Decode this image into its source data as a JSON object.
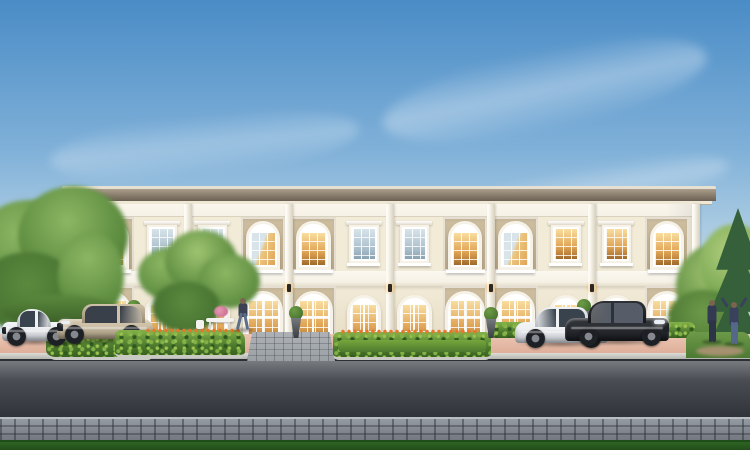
{
  "meta": {
    "description": "Daylight architectural rendering of a symmetric two-storey neoclassical townhome row with arched windows, landscaped front beds, four parked luxury cars, three people and a street with paver sidewalk in the foreground",
    "width_px": 750,
    "height_px": 450
  },
  "palette": {
    "sky_top": "#4a8cc6",
    "sky_mid": "#7fb0d8",
    "sky_low": "#b6d2e5",
    "sky_horizon": "#e9f1f2",
    "roof_edge": "#e6e0d2",
    "roof_fascia_light": "#ab9e8c",
    "roof_fascia_dark": "#6b6052",
    "soffit": "#efe8d7",
    "wall_cream": "#f2ebd8",
    "wall_cream_dark": "#e6dcc3",
    "wall_tan": "#cfbfa1",
    "wall_tan_dark": "#bcab8a",
    "trim": "#f6f2e7",
    "band_shadow": "#d9d2bf",
    "glass_cool_hi": "#d8e4ea",
    "glass_cool_lo": "#a8bdca",
    "glass_warm_hi": "#f9dd9f",
    "glass_warm_lo": "#e0a354",
    "hedge": "#4f7c2f",
    "hedge_light": "#82b148",
    "lawn": "#76a63d",
    "lawn_dark": "#4d7a2e",
    "grass_front": "#2d6423",
    "tree_light": "#8cb763",
    "tree_mid": "#5b8a3e",
    "tree_dark": "#3f6a2c",
    "pine": "#35603a",
    "trunk_brown": "#6a5440",
    "paving_pink": "#ecc7b4",
    "paving_pink_dark": "#d8a48e",
    "walk_gray": "#9aa0a4",
    "road_hi": "#7a7d82",
    "road_mid": "#4a4d53",
    "road_dark": "#303339",
    "curb": "#b3b5b1",
    "sidewalk_hi": "#959ba3",
    "sidewalk_lo": "#70757d",
    "stone_edge": "#c9cac4",
    "flower_orange": "#e5762c",
    "urn_gray": "#4b4e53",
    "skin": "#7a6350"
  },
  "scene": {
    "sky": {
      "cloud_count": 3
    },
    "building": {
      "floors": 2,
      "bay_count": 12,
      "bays": [
        {
          "type": "arched",
          "upper_glass": "warm",
          "ground_glass": "warm"
        },
        {
          "type": "rect",
          "upper_glass": "cool",
          "ground_glass": "warm"
        },
        {
          "type": "rect",
          "upper_glass": "cool",
          "ground_glass": "warm"
        },
        {
          "type": "arched",
          "upper_glass": "mixed",
          "ground_glass": "warm"
        },
        {
          "type": "arched",
          "upper_glass": "warm",
          "ground_glass": "warm"
        },
        {
          "type": "rect",
          "upper_glass": "cool",
          "ground_glass": "warm"
        },
        {
          "type": "rect",
          "upper_glass": "cool",
          "ground_glass": "warm"
        },
        {
          "type": "arched",
          "upper_glass": "warm",
          "ground_glass": "warm"
        },
        {
          "type": "arched",
          "upper_glass": "mixed",
          "ground_glass": "warm"
        },
        {
          "type": "rect",
          "upper_glass": "warm",
          "ground_glass": "warm"
        },
        {
          "type": "rect",
          "upper_glass": "warm",
          "ground_glass": "warm"
        },
        {
          "type": "arched",
          "upper_glass": "warm",
          "ground_glass": "warm"
        }
      ],
      "pilaster_xs": [
        82,
        187.5,
        288.5,
        389.5,
        490.5,
        591.5,
        696
      ],
      "sconce_xs": [
        187.5,
        288.5,
        389.5,
        490.5,
        591.5
      ]
    },
    "cars": [
      {
        "id": "white-coupe-left",
        "style": "coupe",
        "facing": "left",
        "x": 2,
        "y": 306,
        "w": 66,
        "h": 38,
        "body": "#eef0f2",
        "shade": "#b6bac0",
        "glass": "#39434e"
      },
      {
        "id": "champagne-wagon",
        "style": "wagon",
        "facing": "left",
        "x": 57,
        "y": 301,
        "w": 96,
        "h": 41,
        "body": "#cfc2a9",
        "shade": "#978b72",
        "glass": "#3a4049"
      },
      {
        "id": "white-sedan-right",
        "style": "sedan",
        "facing": "right",
        "x": 515,
        "y": 304,
        "w": 93,
        "h": 42,
        "body": "#f0f2f4",
        "shade": "#b9bec5",
        "glass": "#39434e"
      },
      {
        "id": "black-sedan-right",
        "style": "sedan",
        "facing": "right",
        "x": 565,
        "y": 298,
        "w": 104,
        "h": 46,
        "body": "#2e3136",
        "shade": "#16181c",
        "glass": "#565d68"
      }
    ],
    "people": [
      {
        "id": "man-walking-at-door",
        "pose": "walk",
        "x": 236,
        "y": 298,
        "h": 32,
        "top": "#3c4254",
        "legs": "#5d6e88"
      },
      {
        "id": "woman-standing",
        "pose": "stand",
        "x": 705,
        "y": 300,
        "h": 42,
        "top": "#333a52",
        "legs": "#2e3448"
      },
      {
        "id": "person-arms-raised",
        "pose": "arms-up",
        "x": 727,
        "y": 302,
        "h": 42,
        "top": "#39415c",
        "legs": "#55688a"
      }
    ],
    "urns": [
      {
        "x": 126,
        "y": 300,
        "h": 34
      },
      {
        "x": 288,
        "y": 306,
        "h": 32
      },
      {
        "x": 483,
        "y": 307,
        "h": 31
      },
      {
        "x": 576,
        "y": 299,
        "h": 40
      }
    ]
  }
}
